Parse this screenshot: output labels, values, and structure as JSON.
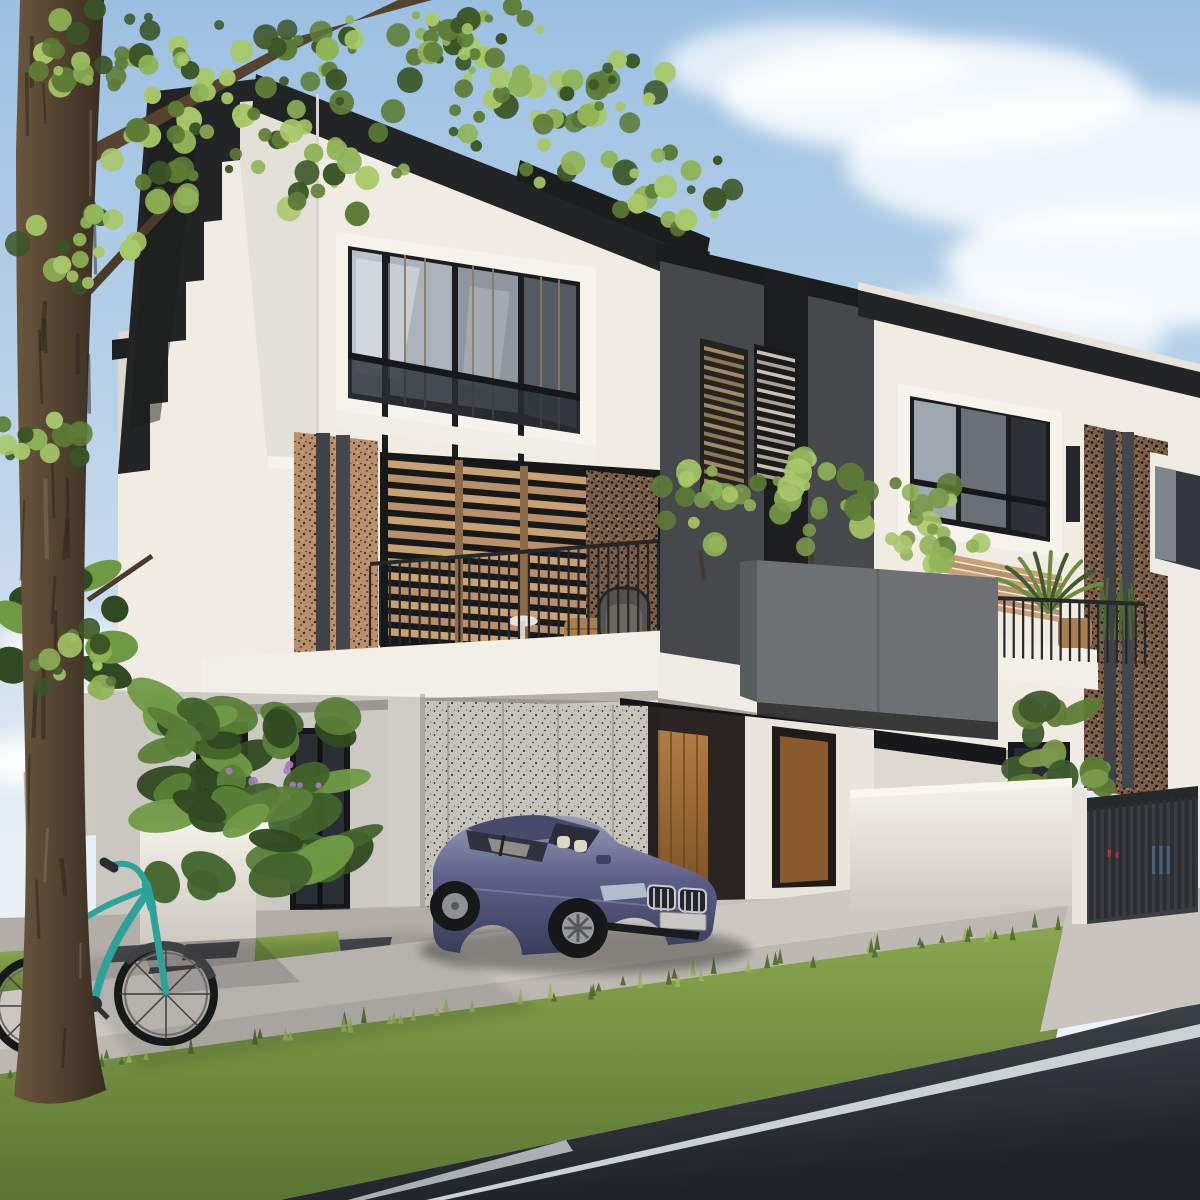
{
  "scene": {
    "setting": "Daylight exterior render of modern three-storey terrace houses with carport, parked sedan, bicycle and street",
    "objects": [
      "sky",
      "clouds",
      "tree",
      "leaves",
      "terrace-house",
      "stepped-gable",
      "black-roof-fascia",
      "corner-window",
      "wood-slat-screen",
      "terrazzo-pier",
      "balcony-railing",
      "balcony-furniture",
      "planter-box",
      "planter-trees",
      "dark-unit",
      "louvre-vents",
      "neighbor-unit",
      "timber-entry-doors",
      "terrazzo-wall",
      "garden-wall",
      "garden-plants",
      "driveway-gate",
      "sedan-car",
      "bicycle",
      "lawn-strips",
      "sidewalk",
      "grass-verge",
      "asphalt-road",
      "road-line",
      "paver-inserts"
    ],
    "car": {
      "type": "sedan",
      "color_name": "dark blue-purple",
      "license_plate": ""
    },
    "bicycle": {
      "color_name": "teal"
    }
  },
  "palette": {
    "sky_top": "#9cc0e2",
    "sky_mid": "#c3d8eb",
    "sky_low": "#e6eff6",
    "sky_horizon": "#f2f6f9",
    "cloud": "#ffffff",
    "wall_lit": "#f0ece3",
    "wall_bright": "#f6f3ec",
    "wall_side": "#ddd8cf",
    "wall_shade": "#cdc9c0",
    "roof_dark": "#222426",
    "gable_dark": "#232425",
    "black_band": "#1b1c1e",
    "charcoal_wall": "#46484b",
    "charcoal_panel": "#1d1e20",
    "planter_gray": "#6e7173",
    "planter_side": "#595c5e",
    "terrazzo_brown": "#b98e6b",
    "terrazzo_brown_dark": "#7c5f49",
    "terrazzo_white": "#e9e5db",
    "speck_dark": "#3a2d22",
    "speck_black": "#1d1814",
    "speck_gray": "#2c2c2c",
    "wood_slat": "#c9a173",
    "wood_slat_alt": "#b9906b",
    "wood_post": "#8d6b48",
    "louvre_bronze": "#a38a64",
    "louvre_silver": "#c8c2b4",
    "door_wood_top": "#b27c44",
    "door_wood_bottom": "#7c5026",
    "door_wood2": "#8a5a2e",
    "glass_light": "#b9c2c9",
    "glass_mid": "#8e979f",
    "glass_dark": "#565b63",
    "glass_deep": "#2e3238",
    "frame_black": "#1a1c1e",
    "mullion_bronze": "#8d7a5d",
    "railing": "#26282a",
    "gate_bar": "#2c2e31",
    "slab_white": "#f2efe7",
    "soffit_dark": "#141516",
    "grass_light": "#8aa64d",
    "grass_dark": "#5a7533",
    "tuft_light": "#9ab55b",
    "tuft_dark": "#4e6a2c",
    "lane": "#c5c1ba",
    "sidewalk": "#ccc8c1",
    "sidewalk_low": "#bdb9b2",
    "apron": "#c9c5be",
    "paver": "#383d40",
    "road_light": "#4a4f56",
    "road_dark": "#1f2227",
    "road_line": "#ccd1d4",
    "car_top": "#979cb8",
    "car_mid": "#5d6087",
    "car_low": "#393c5a",
    "car_glass": "#2b2e3a",
    "car_interior": "#ddd6c0",
    "car_chrome": "#b9bcc2",
    "plate": "#c9c8c4",
    "bike_teal": "#2ba39a",
    "tire": "#17181a",
    "trunk_light": "#6b573f",
    "trunk_dark": "#382c20",
    "branch": "#55432f",
    "leaf_dark": "#3a5526",
    "leaf": "#5d7c35",
    "leaf_light": "#8fb457",
    "leaf_pale": "#a8c869",
    "flower_purple": "#a87cc0",
    "shadow": "#14141a"
  },
  "decor": {
    "main_balcony_rail_bars": 30,
    "unit2_rail_bars": 17,
    "roof_rail_bars": 9,
    "gate_bars": 15,
    "louvre_a_slats": 15,
    "louvre_b_slats": 14,
    "main_screen_slats": 13,
    "unit2_screen_slats": 7,
    "trunk_streaks": 26,
    "grass_tufts": 64,
    "leaf_clusters": 12,
    "cloud_puffs": 9
  }
}
